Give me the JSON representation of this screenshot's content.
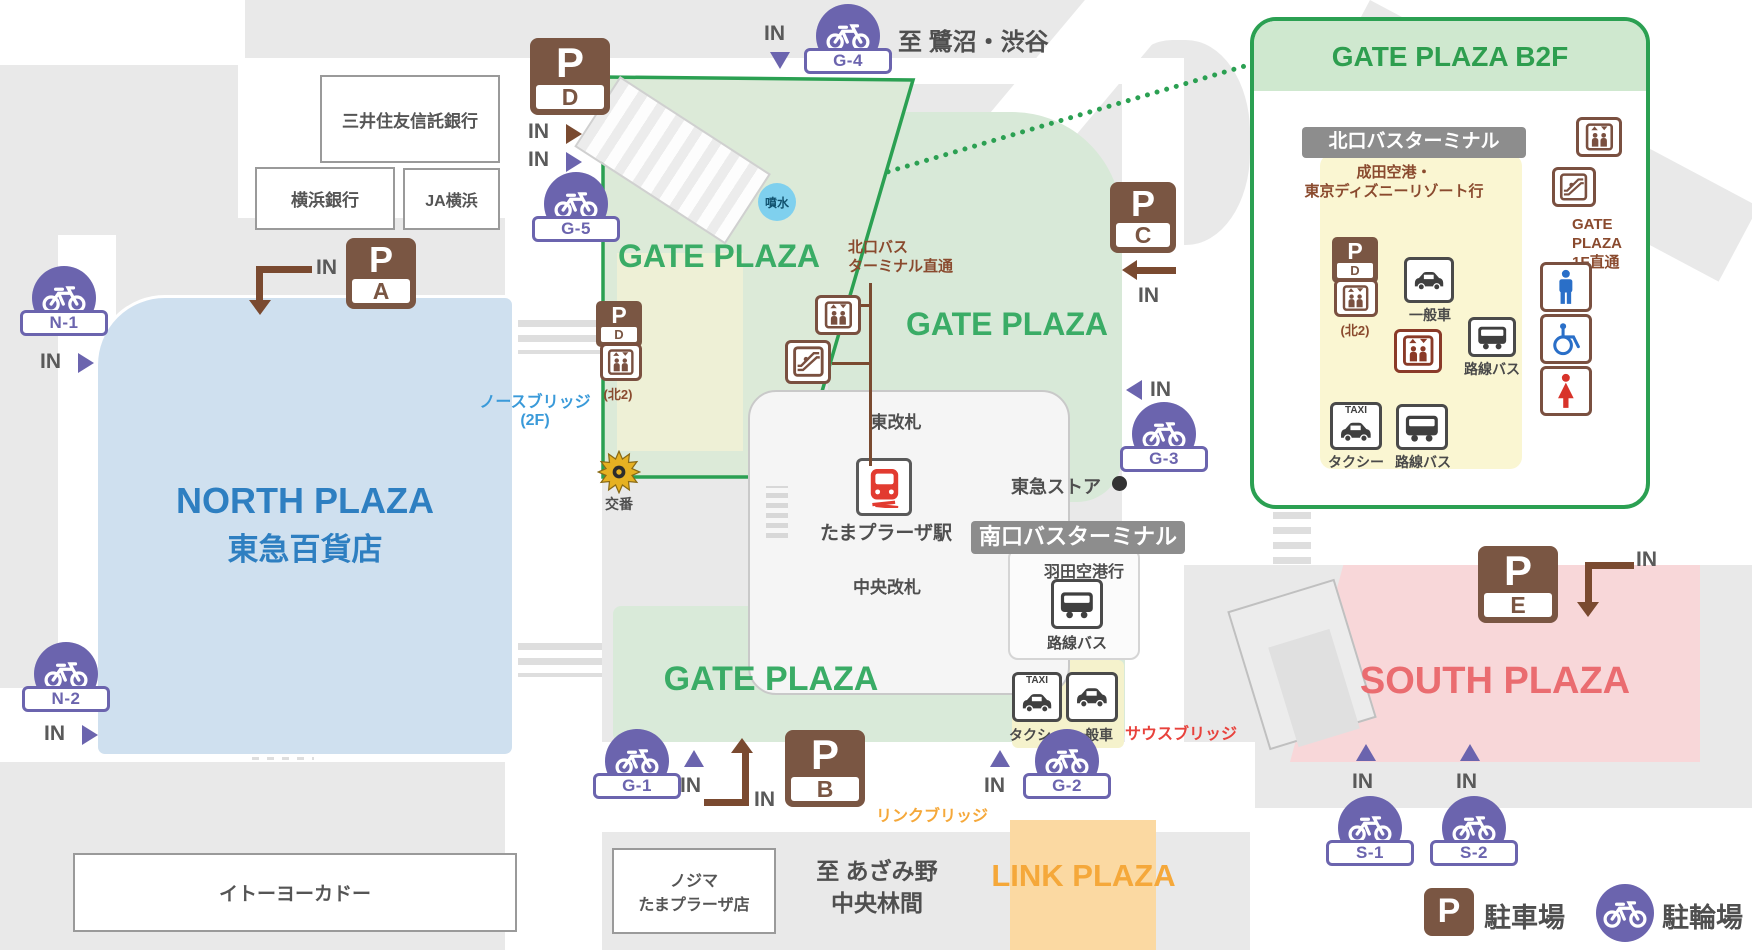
{
  "plazas": {
    "gate": "GATE PLAZA",
    "north_en": "NORTH PLAZA",
    "north_jp": "東急百貨店",
    "south": "SOUTH PLAZA",
    "link": "LINK PLAZA"
  },
  "inset": {
    "title": "GATE PLAZA B2F",
    "terminal": "北口バスターミナル",
    "destination": "成田空港・\n東京ディズニーリゾート行",
    "gate_1f": "GATE\nPLAZA\n1F直通"
  },
  "buildings": {
    "smbc_trust": "三井住友信託銀行",
    "yokohama_bank": "横浜銀行",
    "ja_yokohama": "JA横浜",
    "ito_yokado": "イトーヨーカドー",
    "nojima": "ノジマ\nたまプラーザ店",
    "tokyu_store": "東急ストア"
  },
  "directions": {
    "saginuma_shibuya": "至 鷺沼・渋谷",
    "azamino": "至 あざみ野\n中央林間"
  },
  "station": {
    "east_gate": "東改札",
    "name": "たまプラーザ駅",
    "central_gate": "中央改札"
  },
  "labels": {
    "in": "IN",
    "fountain": "噴水",
    "north_bus_direct": "北口バス\nターミナル直通",
    "south_terminal": "南口バスターミナル",
    "haneda": "羽田空港行",
    "route_bus": "路線バス",
    "taxi": "タクシー",
    "taxi_sign": "TAXI",
    "general_car": "一般車",
    "police_box": "交番",
    "north_bridge": "ノースブリッジ\n(2F)",
    "south_bridge": "サウスブリッジ",
    "link_bridge": "リンクブリッジ",
    "kita2": "(北2)"
  },
  "parking": {
    "p": "P",
    "lots": {
      "a": "A",
      "b": "B",
      "c": "C",
      "d": "D",
      "e": "E"
    }
  },
  "bike_lots": [
    {
      "label": "N-1"
    },
    {
      "label": "N-2"
    },
    {
      "label": "G-1"
    },
    {
      "label": "G-2"
    },
    {
      "label": "G-3"
    },
    {
      "label": "G-4"
    },
    {
      "label": "G-5"
    },
    {
      "label": "S-1"
    },
    {
      "label": "S-2"
    }
  ],
  "legend": {
    "parking": "駐車場",
    "bike_parking": "駐輪場"
  },
  "colors": {
    "green_border": "#2ba052",
    "green_text": "#3aac66",
    "green_fill": "#d8e9d8",
    "purple": "#6b64ae",
    "brown": "#7a5643",
    "north_blue_fill": "#cfe0ef",
    "north_blue_text": "#2e7fc1",
    "south_pink_fill": "#f8d7d9",
    "south_pink_text": "#ea6c70",
    "link_orange_fill": "#fbd9a2",
    "link_orange_text": "#f5a83a",
    "bus_yellow": "#f5f2cc",
    "gray_block": "#e9e9e9"
  }
}
